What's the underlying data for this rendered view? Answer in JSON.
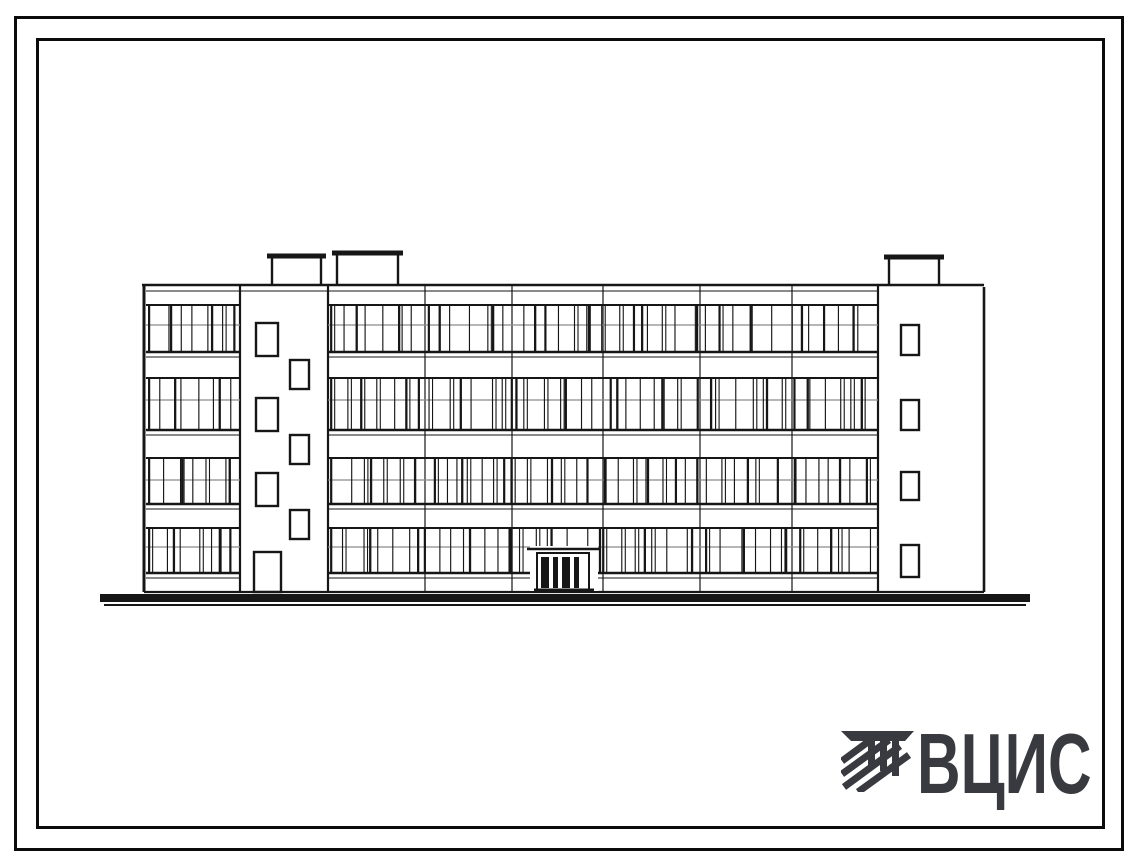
{
  "page": {
    "background_color": "#ffffff",
    "frame_color": "#0b0b0b"
  },
  "logo": {
    "text": "ВЦИС",
    "color": "#393940",
    "icon": "hatched-stripes-monogram-icon"
  },
  "drawing": {
    "type": "architectural-elevation",
    "description": "Scanned line drawing: front elevation of a 4-storey building with continuous ribbon windows, two blank stair towers with staggered small windows, three rooftop vent boxes, central double-door entrance and heavy ground line",
    "ink": "#161616",
    "transom_ink": "#8a8a8a",
    "canvas": {
      "w": 1134,
      "h": 863
    },
    "building": {
      "left": 144,
      "right": 984,
      "roof_y": 285,
      "bottom_y": 592,
      "floors": 4,
      "bands": [
        {
          "top": 305,
          "bottom": 352,
          "transom": 325
        },
        {
          "top": 378,
          "bottom": 430,
          "transom": 400
        },
        {
          "top": 458,
          "bottom": 504,
          "transom": 480
        },
        {
          "top": 528,
          "bottom": 573,
          "transom": 547
        }
      ],
      "glazed_sections": [
        [
          146,
          240
        ],
        [
          328,
          878
        ]
      ],
      "joints": [
        240,
        328,
        425,
        512,
        603,
        700,
        792,
        878
      ],
      "left_tower": {
        "x1": 240,
        "x2": 328,
        "windows": [
          [
            256,
            323,
            22,
            33
          ],
          [
            290,
            360,
            19,
            29
          ],
          [
            256,
            398,
            22,
            33
          ],
          [
            290,
            435,
            19,
            29
          ],
          [
            256,
            473,
            22,
            33
          ],
          [
            290,
            510,
            19,
            29
          ]
        ],
        "door": [
          254,
          552,
          27,
          40
        ]
      },
      "right_tower": {
        "x1": 878,
        "x2": 984,
        "windows": [
          [
            901,
            325,
            18,
            30
          ],
          [
            901,
            400,
            18,
            30
          ],
          [
            901,
            472,
            18,
            28
          ],
          [
            901,
            545,
            18,
            32
          ]
        ]
      },
      "rooftop_boxes": [
        {
          "x": 272,
          "w": 49,
          "bar_y": 254
        },
        {
          "x": 337,
          "w": 61,
          "bar_y": 251
        },
        {
          "x": 889,
          "w": 50,
          "bar_y": 255
        }
      ],
      "entrance": {
        "cover": [
          530,
          546,
          68,
          45
        ],
        "canopy": [
          527,
          600,
          549
        ],
        "frame": [
          537,
          553,
          52,
          37
        ],
        "leaves": [
          [
            541,
            557,
            8,
            31
          ],
          [
            553,
            557,
            5,
            31
          ],
          [
            562,
            557,
            8,
            31
          ],
          [
            574,
            557,
            5,
            31
          ]
        ],
        "threshold": [
          534,
          594,
          590
        ]
      },
      "ground": {
        "main": [
          100,
          1030,
          598,
          8
        ],
        "thin": [
          104,
          1026,
          605,
          2
        ]
      }
    }
  }
}
